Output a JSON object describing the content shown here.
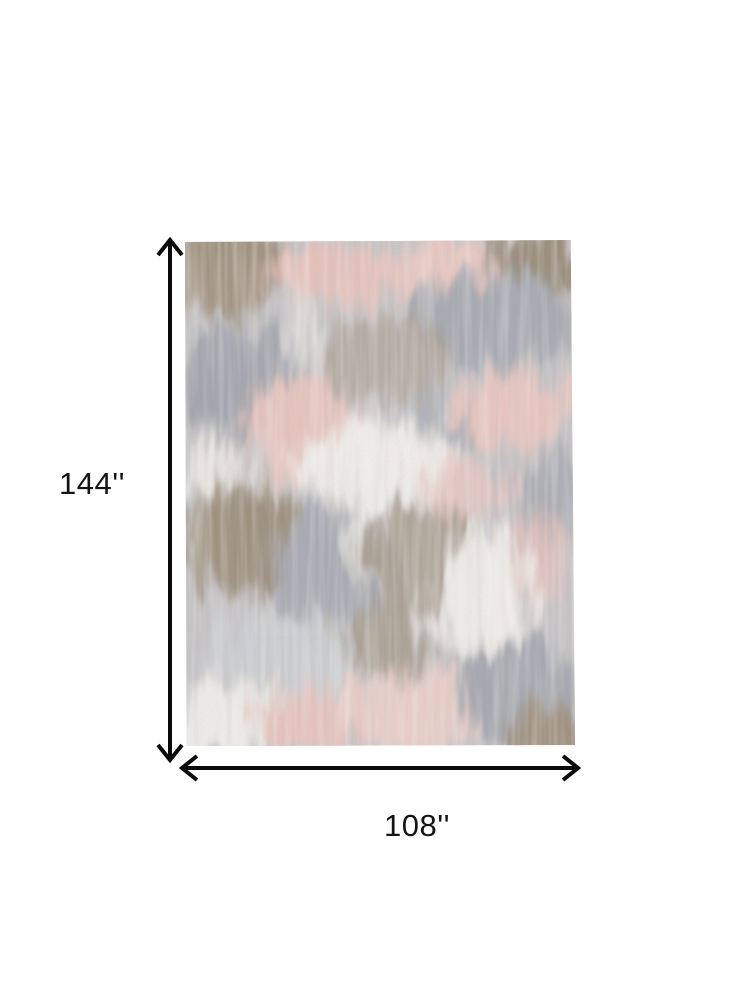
{
  "page": {
    "background_color": "#ffffff",
    "description": "Product dimension diagram of an abstract distressed area rug"
  },
  "dimensions": {
    "height_label": "144''",
    "width_label": "108''"
  },
  "icons": {
    "vertical_arrow": "double-headed-arrow-vertical",
    "horizontal_arrow": "double-headed-arrow-horizontal"
  },
  "style": {
    "arrow_color": "#0a0a0a",
    "label_color": "#141414"
  },
  "rug": {
    "palette": {
      "base_gray": "#c7c5c7",
      "light_gray": "#cdcfd2",
      "gray_blue": "#a5a8b1",
      "taupe": "#a09280",
      "dark_taupe": "#8f8371",
      "blush_pink": "#e9c5bf",
      "soft_pink": "#eed2cc",
      "cream_white": "#f1efe9"
    }
  }
}
